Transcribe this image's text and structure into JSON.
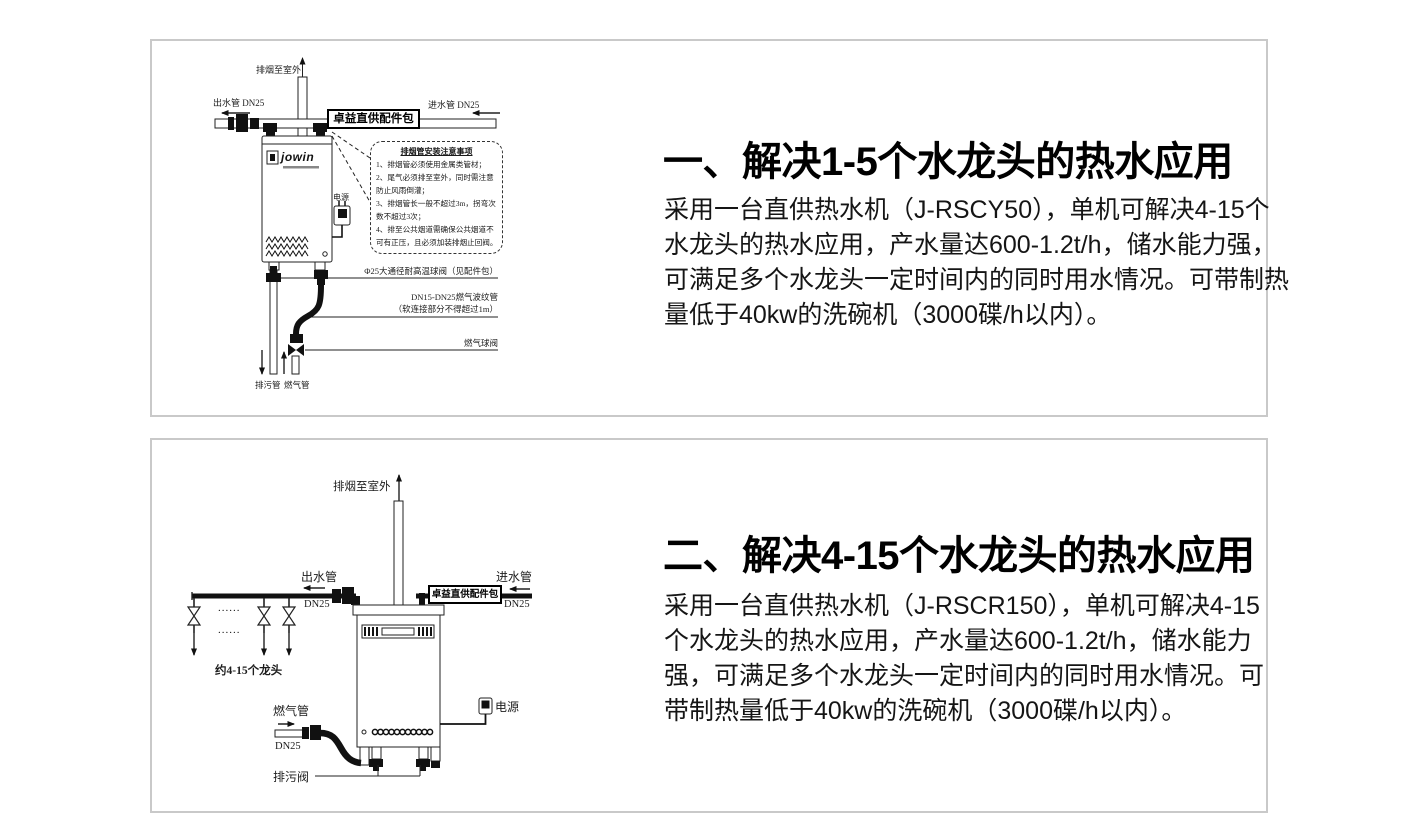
{
  "page": {
    "background": "#ffffff",
    "panel_border": "#c9c9c9",
    "text_color": "#151515"
  },
  "panels": [
    {
      "title": "一、解决1-5个水龙头的热水应用",
      "body_lines": [
        "采用一台直供热水机（J-RSCY50），单机可解决4-15个",
        "水龙头的热水应用，产水量达600-1.2t/h，储水能力强，",
        "可满足多个水龙头一定时间内的同时用水情况。可带制热",
        "量低于40kw的洗碗机（3000碟/h以内）。"
      ],
      "diagram": {
        "exhaust_label": "排烟至室外",
        "outlet_label": "出水管 DN25",
        "inlet_label": "进水管 DN25",
        "kit_label": "卓益直供配件包",
        "brand": "jowin",
        "power_label": "电源",
        "notice_title": "排烟管安装注意事项",
        "notice_lines": [
          "1、排烟管必须使用金属类管材；",
          "2、尾气必须排至室外，同时需注意",
          "防止风雨倒灌；",
          "3、排烟管长一般不超过3m，拐弯次",
          "数不超过3次；",
          "4、排至公共烟道需确保公共烟道不",
          "可有正压，且必须加装排烟止回阀。"
        ],
        "ball_valve_label": "Φ25大通径耐高温球阀（见配件包）",
        "gas_hose_label_line1": "DN15-DN25燃气波纹管",
        "gas_hose_label_line2": "（软连接部分不得超过1m）",
        "gas_valve_label": "燃气球阀",
        "drain_pipe_label": "排污管",
        "gas_pipe_label": "燃气管"
      }
    },
    {
      "title": "二、解决4-15个水龙头的热水应用",
      "body_lines": [
        "采用一台直供热水机（J-RSCR150），单机可解决4-15",
        "个水龙头的热水应用，产水量达600-1.2t/h，储水能力",
        "强，可满足多个水龙头一定时间内的同时用水情况。可",
        "带制热量低于40kw的洗碗机（3000碟/h以内）。"
      ],
      "diagram": {
        "exhaust_label": "排烟至室外",
        "outlet_label": "出水管",
        "outlet_dn": "DN25",
        "inlet_label": "进水管",
        "inlet_dn": "DN25",
        "kit_label": "卓益直供配件包",
        "dots": "......",
        "taps_label": "约4-15个龙头",
        "gas_pipe_label": "燃气管",
        "gas_dn": "DN25",
        "power_label": "电源",
        "drain_valve_label": "排污阀"
      }
    }
  ]
}
